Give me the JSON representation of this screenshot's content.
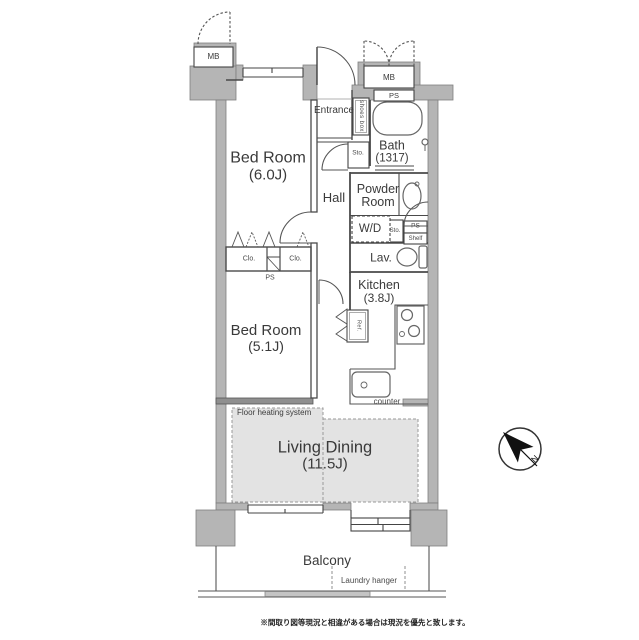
{
  "rooms": {
    "bedroom1": {
      "name": "Bed Room",
      "size": "(6.0J)"
    },
    "bedroom2": {
      "name": "Bed Room",
      "size": "(5.1J)"
    },
    "living_dining": {
      "name": "Living Dining",
      "size": "(11.5J)"
    },
    "kitchen": {
      "name": "Kitchen",
      "size": "(3.8J)"
    },
    "bath": {
      "name": "Bath",
      "size": "(1317)"
    },
    "powder_room": {
      "name": "Powder Room"
    },
    "hall": {
      "name": "Hall"
    },
    "entrance": {
      "name": "Entrance"
    },
    "lavatory": {
      "name": "Lav."
    },
    "washer_dryer": {
      "name": "W/D"
    },
    "balcony": {
      "name": "Balcony"
    }
  },
  "fixtures": {
    "mb_left": "MB",
    "mb_right": "MB",
    "ps_top": "PS",
    "ps_utility": "PS",
    "ps_closet": "PS",
    "sto_hall": "Sto.",
    "sto_utility": "Sto.",
    "shelf": "Shelf",
    "shoes_box": "shoes box",
    "closet_left": "Clo.",
    "closet_right": "Clo.",
    "refrigerator": "Ref.",
    "counter": "counter",
    "floor_heating": "Floor heating system",
    "laundry_hanger": "Laundry hanger"
  },
  "compass": {
    "north_label": "N"
  },
  "footer": {
    "disclaimer": "※間取り図等現況と相違がある場合は現況を優先と致します。"
  },
  "colors": {
    "wall": "#b5b5b5",
    "wall_dark": "#8f8f8f",
    "line": "#4a4a4a",
    "heating_fill": "#e3e3e3",
    "text": "#3a3a3a"
  }
}
